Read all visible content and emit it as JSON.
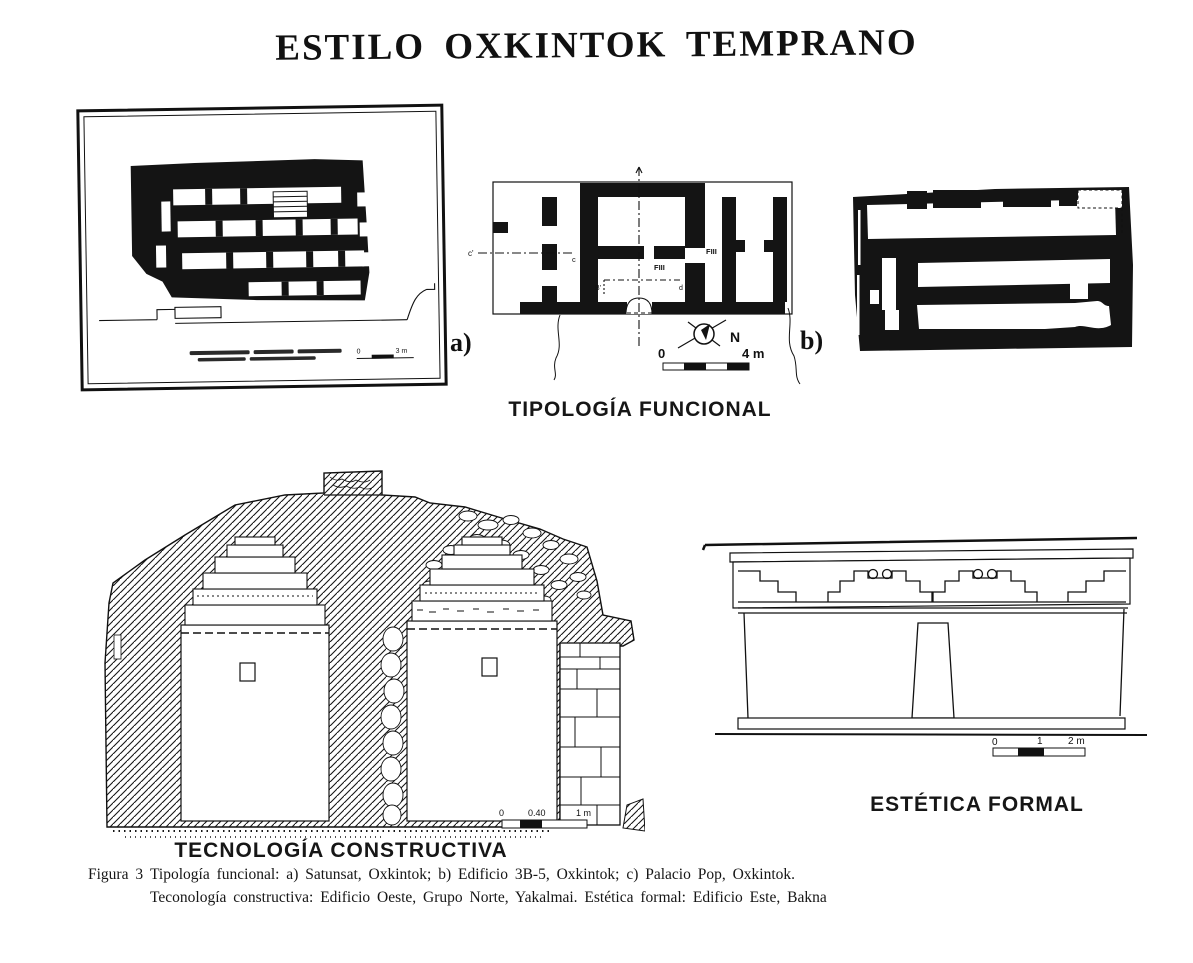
{
  "page": {
    "title": "ESTILO OXKINTOK TEMPRANO"
  },
  "figure": {
    "tipologia_label": "TIPOLOGÍA FUNCIONAL",
    "tecnologia_label": "TECNOLOGÍA CONSTRUCTIVA",
    "estetica_label": "ESTÉTICA FORMAL"
  },
  "plan_a": {
    "label": "a)",
    "scale": {
      "zero": "0",
      "end": "3 m"
    }
  },
  "plan_b": {
    "label": "b)",
    "north_label": "N",
    "room_labels": [
      "FIII",
      "FIII"
    ],
    "section_labels": {
      "c_prime": "c'",
      "c": "c",
      "b_prime": "B'",
      "d": "d"
    },
    "scale": {
      "zero": "0",
      "end": "4 m"
    }
  },
  "section_drawing": {
    "scale": {
      "zero": "0",
      "mid": "0.40",
      "end": "1 m"
    }
  },
  "elevation_drawing": {
    "scale": {
      "zero": "0",
      "mid": "1",
      "end": "2 m"
    }
  },
  "caption": {
    "figure_label": "Figura 3",
    "line1": "Tipología funcional: a) Satunsat, Oxkintok; b) Edificio 3B-5, Oxkintok; c) Palacio Pop, Oxkintok.",
    "line2": "Teconología constructiva: Edificio Oeste, Grupo Norte, Yakalmai.  Estética formal: Edificio Este, Bakna"
  }
}
